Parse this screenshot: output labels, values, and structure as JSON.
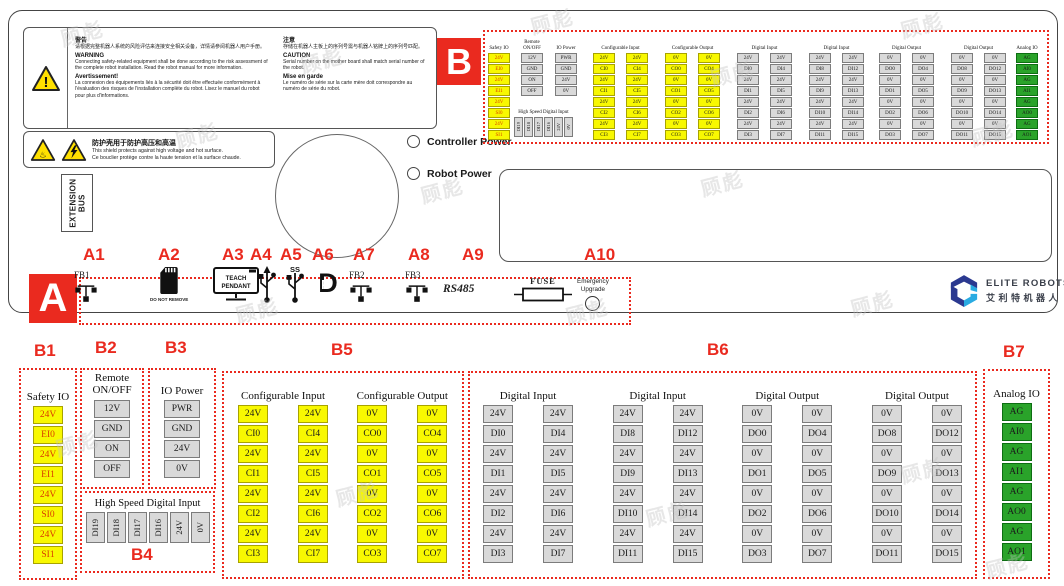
{
  "watermark": "顾彪",
  "colors": {
    "accent_red": "#ea2a1f",
    "cell_yellow": "#f8f801",
    "cell_gray": "#d9d9d9",
    "cell_green": "#2aa32a",
    "safety_text": "#d93a00",
    "logo_dark_blue": "#2b3990",
    "logo_light_blue": "#29abe2"
  },
  "board": {
    "warning": {
      "zh_title": "警告",
      "zh_body": "请根据完整机器人系统的风险评估来连接安全相关设备，详情请参阅机器人用户手册。",
      "en_title": "WARNING",
      "en_body": "Connecting safety-related equipment shall be done according to the risk assessment of the complete robot installation. Read the robot manual for more information.",
      "fr_title": "Avertissement!",
      "fr_body": "La connexion des équipements liés à la sécurité doit être effectuée conformément à l'évaluation des risques de l'installation complète du robot. Lisez le manuel du robot pour plus d'informations."
    },
    "caution": {
      "zh_title": "注意",
      "zh_body": "存储在机器人主板上的序列号需与机器人铭牌上的序列号匹配。",
      "en_title": "CAUTION",
      "en_body": "Serial number on the mother board shall match serial number of the robot.",
      "fr_title": "Mise en garde",
      "fr_body": "Le numéro de série sur la carte mère doit correspondre au numéro de série du robot."
    },
    "shield": {
      "zh": "防护壳用于防护高压和高温",
      "en": "This shield protects against high voltage and hot surface.",
      "fr": "Ce bouclier protège contre la haute tension et la surface chaude."
    },
    "extension_bus": "EXTENSION BUS",
    "leds": [
      "Controller Power",
      "Robot Power"
    ]
  },
  "section_a": {
    "label": "A",
    "callouts": [
      "A1",
      "A2",
      "A3",
      "A4",
      "A5",
      "A6",
      "A7",
      "A8",
      "A9",
      "A10"
    ],
    "items": {
      "fb1": "FB1",
      "fb2": "FB2",
      "fb3": "FB3",
      "sd_note": "DO NOT REMOVE",
      "pendant1": "TEACH",
      "pendant2": "PENDANT",
      "usb_ss_mark": "SS",
      "dp_d": "D",
      "dp_p": "P",
      "rs485": "RS485",
      "fuse": "FUSE",
      "emergency1": "Emergency",
      "emergency2": "Upgrade"
    }
  },
  "section_b": {
    "label": "B",
    "callouts": [
      "B1",
      "B2",
      "B3",
      "B4",
      "B5",
      "B6",
      "B7"
    ],
    "groups": [
      {
        "id": "safety",
        "title": "Safety IO",
        "color": "yellow",
        "cols": [
          [
            "24V",
            "EI0",
            "24V",
            "EI1",
            "24V",
            "SI0",
            "24V",
            "SI1"
          ]
        ]
      },
      {
        "id": "remote",
        "title": "Remote ON/OFF",
        "color": "gray",
        "cols": [
          [
            "12V",
            "GND",
            "ON",
            "OFF"
          ]
        ]
      },
      {
        "id": "iopower",
        "title": "IO Power",
        "color": "gray",
        "cols": [
          [
            "PWR",
            "GND",
            "24V",
            "0V"
          ]
        ]
      },
      {
        "id": "hsdi",
        "title": "High Speed Digital Input",
        "color": "gray",
        "horizontal": true,
        "cols": [
          [
            "DI19",
            "DI18",
            "DI17",
            "DI16",
            "24V",
            "0V"
          ]
        ]
      },
      {
        "id": "ci",
        "title": "Configurable Input",
        "color": "yellow",
        "cols": [
          [
            "24V",
            "CI0",
            "24V",
            "CI1",
            "24V",
            "CI2",
            "24V",
            "CI3"
          ],
          [
            "24V",
            "CI4",
            "24V",
            "CI5",
            "24V",
            "CI6",
            "24V",
            "CI7"
          ]
        ]
      },
      {
        "id": "co",
        "title": "Configurable Output",
        "color": "yellow",
        "cols": [
          [
            "0V",
            "CO0",
            "0V",
            "CO1",
            "0V",
            "CO2",
            "0V",
            "CO3"
          ],
          [
            "0V",
            "CO4",
            "0V",
            "CO5",
            "0V",
            "CO6",
            "0V",
            "CO7"
          ]
        ]
      },
      {
        "id": "di1",
        "title": "Digital Input",
        "color": "gray",
        "cols": [
          [
            "24V",
            "DI0",
            "24V",
            "DI1",
            "24V",
            "DI2",
            "24V",
            "DI3"
          ],
          [
            "24V",
            "DI4",
            "24V",
            "DI5",
            "24V",
            "DI6",
            "24V",
            "DI7"
          ]
        ]
      },
      {
        "id": "di2",
        "title": "Digital Input",
        "color": "gray",
        "cols": [
          [
            "24V",
            "DI8",
            "24V",
            "DI9",
            "24V",
            "DI10",
            "24V",
            "DI11"
          ],
          [
            "24V",
            "DI12",
            "24V",
            "DI13",
            "24V",
            "DI14",
            "24V",
            "DI15"
          ]
        ]
      },
      {
        "id": "do1",
        "title": "Digital Output",
        "color": "gray",
        "cols": [
          [
            "0V",
            "DO0",
            "0V",
            "DO1",
            "0V",
            "DO2",
            "0V",
            "DO3"
          ],
          [
            "0V",
            "DO4",
            "0V",
            "DO5",
            "0V",
            "DO6",
            "0V",
            "DO7"
          ]
        ]
      },
      {
        "id": "do2",
        "title": "Digital Output",
        "color": "gray",
        "cols": [
          [
            "0V",
            "DO8",
            "0V",
            "DO9",
            "0V",
            "DO10",
            "0V",
            "DO11"
          ],
          [
            "0V",
            "DO12",
            "0V",
            "DO13",
            "0V",
            "DO14",
            "0V",
            "DO15"
          ]
        ]
      },
      {
        "id": "analog",
        "title": "Analog IO",
        "color": "green",
        "cols": [
          [
            "AG",
            "AI0",
            "AG",
            "AI1",
            "AG",
            "AO0",
            "AG",
            "AO1"
          ]
        ]
      }
    ]
  },
  "logo": {
    "brand": "ELITE ROBOTS",
    "brand_zh": "艾利特机器人"
  }
}
